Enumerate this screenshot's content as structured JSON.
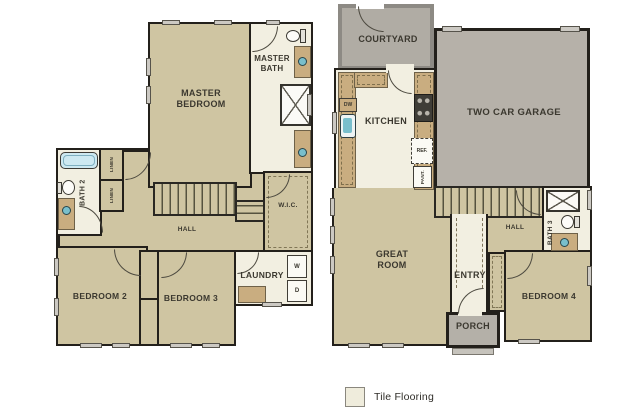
{
  "legend": {
    "tile_label": "Tile Flooring"
  },
  "colors": {
    "carpet": "#cfc5a2",
    "tile": "#f2efe1",
    "garage": "#b6b1a9",
    "courtyard": "#b0aca4",
    "porch": "#b4b0a8",
    "wall": "#23201b",
    "counter": "#c9ad80",
    "fixture_blue": "#79bfcc",
    "tub_blue": "#cde9f1"
  },
  "upper_floor": {
    "master_bedroom": "MASTER\nBEDROOM",
    "master_bath": "MASTER\nBATH",
    "bath2": "BATH 2",
    "linen_top": "LINEN",
    "linen_bottom": "LINEN",
    "hall": "HALL",
    "wic": "W.I.C.",
    "laundry": "LAUNDRY",
    "washer": "W",
    "dryer": "D",
    "bedroom2": "BEDROOM 2",
    "bedroom3": "BEDROOM 3"
  },
  "lower_floor": {
    "courtyard": "COURTYARD",
    "kitchen": "KITCHEN",
    "dishwasher": "DW",
    "refrigerator": "REF.",
    "pantry": "PANT.",
    "garage": "TWO CAR GARAGE",
    "great_room": "GREAT\nROOM",
    "hall": "HALL",
    "bath3": "BATH 3",
    "entry": "ENTRY",
    "porch": "PORCH",
    "bedroom4": "BEDROOM 4"
  }
}
